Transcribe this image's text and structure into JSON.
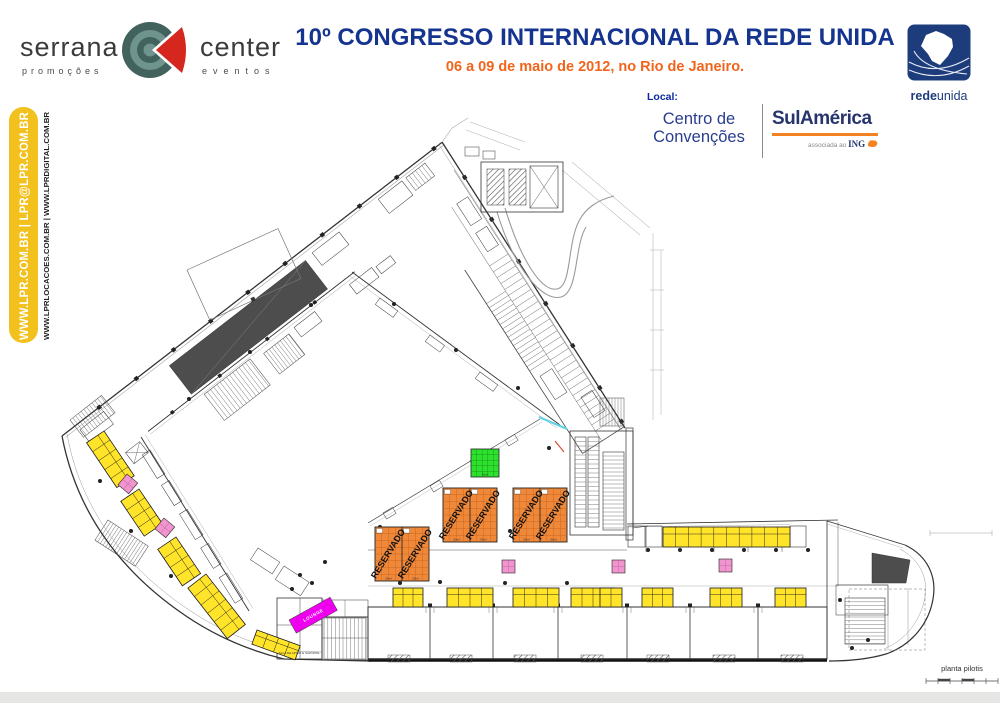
{
  "header": {
    "logo": {
      "name_left": "serrana",
      "sub_left": "promoções",
      "name_right": "center",
      "sub_right": "eventos"
    },
    "title": "10º CONGRESSO INTERNACIONAL DA REDE UNIDA",
    "subtitle": "06 a 09 de maio de 2012, no Rio de Janeiro.",
    "local_label": "Local:",
    "venue": {
      "line1": "Centro de",
      "line2": "Convenções",
      "partner": "SulAmérica",
      "partner_sub_prefix": "associada ao",
      "partner_sub_brand": "ING"
    },
    "redeunida": {
      "bold": "rede",
      "regular": "unida"
    }
  },
  "sidebar": {
    "primary": "WWW.LPR.COM.BR | LPR@LPR.COM.BR",
    "secondary": "WWW.LPRLOCACOES.COM.BR | WWW.LPRDIGITAL.COM.BR"
  },
  "plan": {
    "caption": "planta pilotis",
    "reservado_label": "RESERVADO",
    "area_label": "30m²",
    "lounge_label": "LOUNGE",
    "support_label": "SALA DE APOIO E SUPORTE",
    "colors": {
      "booth_yellow": "#FFE42A",
      "booth_line": "#1a1a1a",
      "reserved_orange": "#F0883A",
      "reserved_line": "#C06018",
      "green": "#2FE12F",
      "green_line": "#149C14",
      "pink": "#F095CE",
      "pink_line": "#C468A6",
      "magenta": "#EE00EE",
      "dark_fill": "#4D4D4D",
      "title_navy": "#15348F",
      "accent_orange": "#F2641C",
      "sidebar_yellow": "#F2C11E"
    },
    "booth_groups": [
      {
        "x": 104,
        "y": 431,
        "w": 54,
        "h": 21,
        "cols": 5,
        "rot": 56
      },
      {
        "x": 139,
        "y": 489,
        "w": 42,
        "h": 22,
        "cols": 4,
        "rot": 56
      },
      {
        "x": 176,
        "y": 537,
        "w": 44,
        "h": 22,
        "cols": 4,
        "rot": 56
      },
      {
        "x": 206,
        "y": 574,
        "w": 64,
        "h": 23,
        "cols": 6,
        "rot": 52
      },
      {
        "x": 257,
        "y": 630,
        "w": 46,
        "h": 15,
        "cols": 4,
        "rot": 20
      },
      {
        "x": 393,
        "y": 588,
        "w": 30,
        "h": 19,
        "cols": 3,
        "rot": 0
      },
      {
        "x": 447,
        "y": 588,
        "w": 46,
        "h": 19,
        "cols": 4,
        "rot": 0
      },
      {
        "x": 513,
        "y": 588,
        "w": 46,
        "h": 19,
        "cols": 4,
        "rot": 0
      },
      {
        "x": 571,
        "y": 588,
        "w": 44,
        "h": 19,
        "cols": 4,
        "rot": 0
      },
      {
        "x": 600,
        "y": 588,
        "w": 22,
        "h": 19,
        "cols": 2,
        "rot": 0
      },
      {
        "x": 642,
        "y": 588,
        "w": 31,
        "h": 19,
        "cols": 3,
        "rot": 0
      },
      {
        "x": 710,
        "y": 588,
        "w": 32,
        "h": 19,
        "cols": 3,
        "rot": 0
      },
      {
        "x": 775,
        "y": 588,
        "w": 31,
        "h": 19,
        "cols": 3,
        "rot": 0
      },
      {
        "x": 663,
        "y": 527,
        "w": 127,
        "h": 20,
        "cols": 10,
        "rot": 0
      }
    ],
    "pink_booths": [
      {
        "x": 502,
        "y": 560,
        "s": 13,
        "rot": 0
      },
      {
        "x": 612,
        "y": 560,
        "s": 13,
        "rot": 0
      },
      {
        "x": 719,
        "y": 559,
        "s": 13,
        "rot": 0
      },
      {
        "x": 127,
        "y": 474,
        "s": 14,
        "rot": 40
      },
      {
        "x": 164,
        "y": 518,
        "s": 14,
        "rot": 40
      }
    ],
    "reserved_blocks": [
      {
        "x": 375,
        "y": 527
      },
      {
        "x": 443,
        "y": 488
      },
      {
        "x": 513,
        "y": 488
      }
    ],
    "reserved_size": 54,
    "green_booth": {
      "x": 471,
      "y": 449,
      "size": 28
    },
    "lounge": {
      "x": 289,
      "y": 620,
      "w": 47,
      "h": 15,
      "rot": -29
    }
  }
}
